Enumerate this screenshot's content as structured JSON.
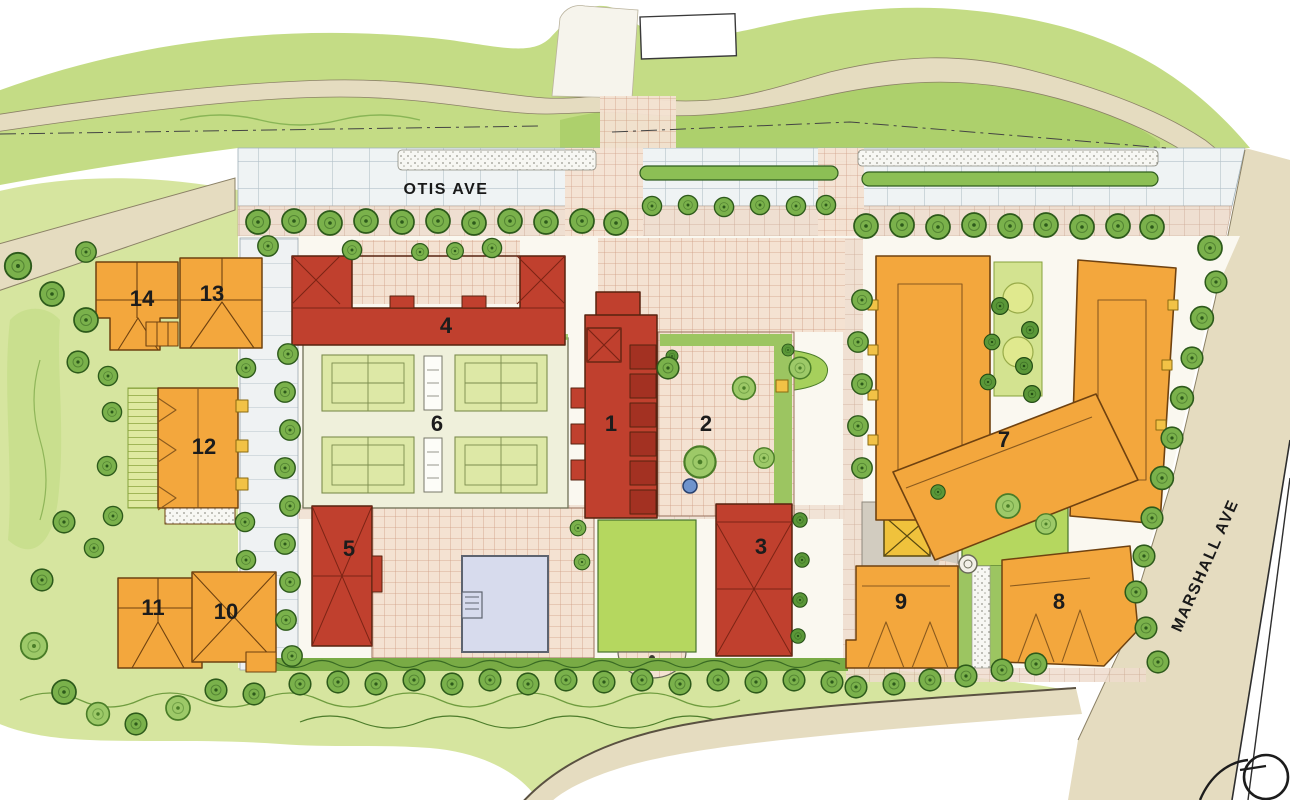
{
  "streets": {
    "otis": "OTIS AVE",
    "marshall": "MARSHALL AVE"
  },
  "buildings": [
    {
      "id": "1",
      "label": "1"
    },
    {
      "id": "2",
      "label": "2"
    },
    {
      "id": "3",
      "label": "3"
    },
    {
      "id": "4",
      "label": "4"
    },
    {
      "id": "5",
      "label": "5"
    },
    {
      "id": "6",
      "label": "6"
    },
    {
      "id": "7",
      "label": "7"
    },
    {
      "id": "8",
      "label": "8"
    },
    {
      "id": "9",
      "label": "9"
    },
    {
      "id": "10",
      "label": "10"
    },
    {
      "id": "11",
      "label": "11"
    },
    {
      "id": "12",
      "label": "12"
    },
    {
      "id": "13",
      "label": "13"
    },
    {
      "id": "14",
      "label": "14"
    }
  ],
  "legend_colors": {
    "red_building": "#c0402e",
    "orange_building": "#f3a73d",
    "lawn": "#b5d75f",
    "meadow": "#d6e59f",
    "tree_canopy": "#7ab14b",
    "plaza_paving": "#f4e2d2",
    "street_paving": "#e5dcc0",
    "tennis_court": "#dde8a6",
    "pool_water": "#d7dbed",
    "label_text": "#1c1c1c"
  }
}
